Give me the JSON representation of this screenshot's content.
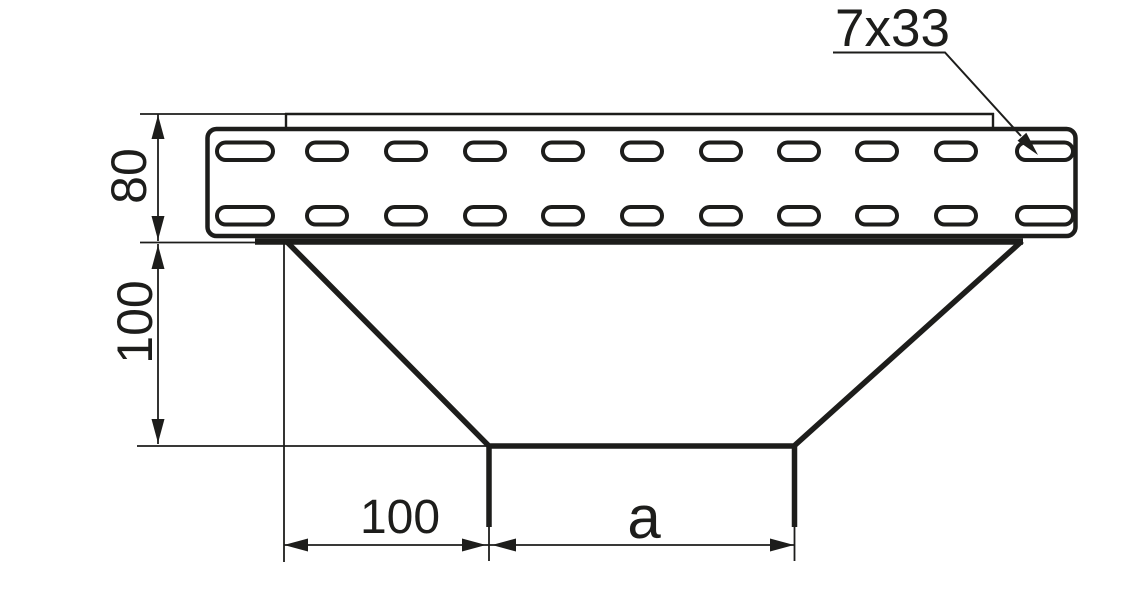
{
  "drawing": {
    "line_color": "#1d1d1b",
    "background_color": "#ffffff",
    "labels": {
      "perforation_spec": "7x33",
      "side_height": "80",
      "branch_depth": "100",
      "branch_offset": "100",
      "branch_width": "a"
    }
  }
}
